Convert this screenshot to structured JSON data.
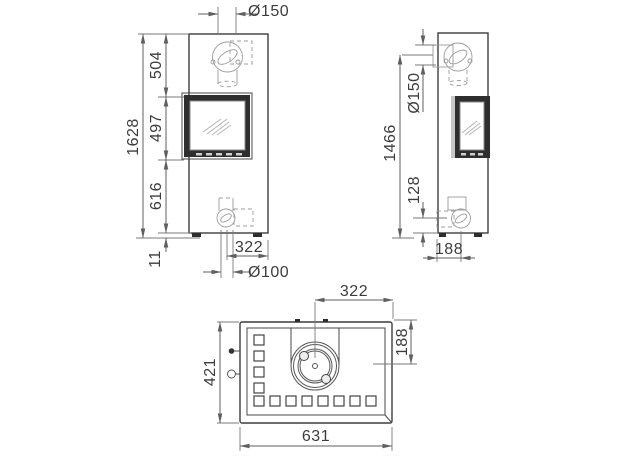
{
  "colors": {
    "background": "#ffffff",
    "outline": "#3d3d3d",
    "dimension": "#5f5f5f",
    "window_frame": "#2e2e2e"
  },
  "front_view": {
    "title": "front elevation",
    "dims": {
      "top_flue_diameter": "Ø150",
      "total_height": "1628",
      "top_to_window": "504",
      "window_height": "497",
      "window_to_base": "616",
      "foot_height": "11",
      "bottom_outlet_offset": "322",
      "bottom_outlet_diameter": "Ø100"
    }
  },
  "side_view": {
    "title": "side elevation",
    "dims": {
      "rear_flue_height": "1466",
      "rear_flue_diameter": "Ø150",
      "bottom_outlet_height": "128",
      "bottom_outlet_depth_offset": "188"
    }
  },
  "top_view": {
    "title": "plan view",
    "dims": {
      "flue_center_from_right": "322",
      "flue_center_from_front": "188",
      "depth": "421",
      "width": "631"
    }
  }
}
